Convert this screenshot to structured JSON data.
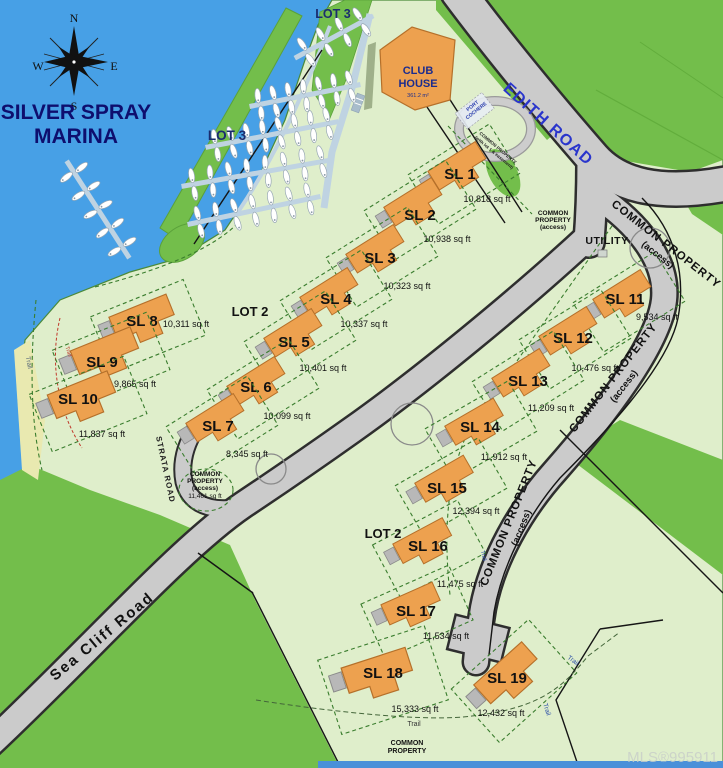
{
  "map": {
    "title": {
      "line1": "SILVER SPRAY",
      "line2": "MARINA"
    },
    "compass": {
      "north": "N",
      "south": "S",
      "east": "E",
      "west": "W"
    },
    "watermark": "MLS®995911",
    "colors": {
      "water": "#47A0E6",
      "land_pale": "#DFEECB",
      "land_green": "#73BE4B",
      "road": "#CBCBCB",
      "house": "#EDA14F",
      "dock": "#BFD3E2",
      "title_navy": "#0E0E6E",
      "road_label_blue": "#2A35CC"
    },
    "area_labels": {
      "lot3_top": "LOT 3",
      "lot3_water": "LOT 3",
      "lot2_west": "LOT 2",
      "lot2_south": "LOT 2"
    },
    "roads": {
      "edith_road": "EDITH ROAD",
      "sea_cliff_road": "Sea Cliff Road",
      "strata_road": "STRATA ROAD"
    },
    "utility_label": "UTILITY",
    "trail_label": "Trail",
    "club_house": {
      "line1": "CLUB",
      "line2": "HOUSE",
      "area": "361.2 m²",
      "port_cochere": [
        "PORT",
        "COCHERE"
      ]
    },
    "common_property": {
      "road_label_main": "COMMON PROPERTY",
      "road_label_sub": "(access)",
      "edith_small": [
        "COMMON",
        "PROPERTY",
        "(access)"
      ],
      "strata_parcel": [
        "COMMON",
        "PROPERTY",
        "(access)",
        "11,461 sq ft"
      ],
      "south_parcel": [
        "COMMON",
        "PROPERTY"
      ],
      "lot1_strip": [
        "COMMON PROPERTY",
        "(with lot 1 & easement)"
      ]
    },
    "lots": [
      {
        "id": "SL 1",
        "area": "10,818 sq ft"
      },
      {
        "id": "SL 2",
        "area": "10,938 sq ft"
      },
      {
        "id": "SL 3",
        "area": "10,323 sq ft"
      },
      {
        "id": "SL 4",
        "area": "10,337 sq ft"
      },
      {
        "id": "SL 5",
        "area": "10,401 sq ft"
      },
      {
        "id": "SL 6",
        "area": "10,099 sq ft"
      },
      {
        "id": "SL 7",
        "area": "8,345 sq ft"
      },
      {
        "id": "SL 8",
        "area": "10,311 sq ft"
      },
      {
        "id": "SL 9",
        "area": "9,865 sq ft"
      },
      {
        "id": "SL 10",
        "area": "11,837 sq ft"
      },
      {
        "id": "SL 11",
        "area": "9,534 sq ft"
      },
      {
        "id": "SL 12",
        "area": "10,476 sq ft"
      },
      {
        "id": "SL 13",
        "area": "11,209 sq ft"
      },
      {
        "id": "SL 14",
        "area": "11,912 sq ft"
      },
      {
        "id": "SL 15",
        "area": "12,394 sq ft"
      },
      {
        "id": "SL 16",
        "area": "11,475 sq ft"
      },
      {
        "id": "SL 17",
        "area": "11,534 sq ft"
      },
      {
        "id": "SL 18",
        "area": "15,333 sq ft"
      },
      {
        "id": "SL 19",
        "area": "12,432 sq ft"
      }
    ]
  }
}
